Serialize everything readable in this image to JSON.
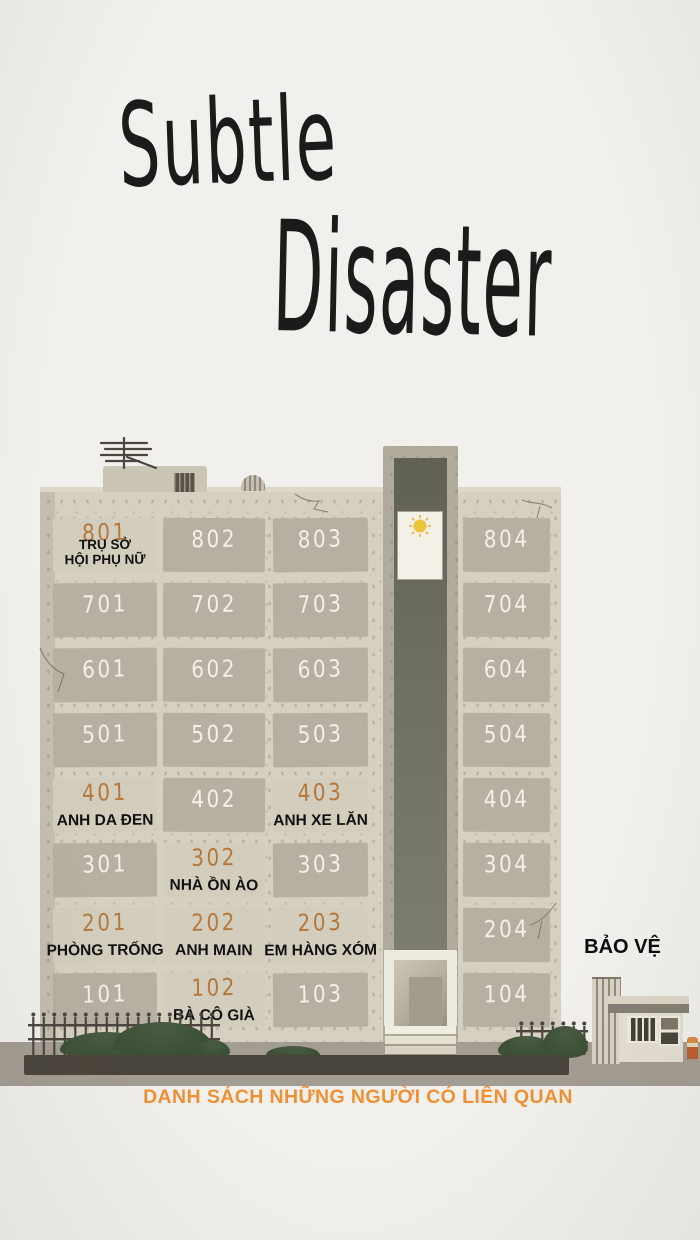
{
  "title": {
    "word1": "Subtle",
    "word2": "Disaster"
  },
  "building": {
    "floors": [
      {
        "level": 8,
        "rooms": [
          {
            "number": "801",
            "highlighted": true,
            "label_lines": [
              "TRỤ SỞ",
              "HỘI PHỤ NỮ"
            ]
          },
          {
            "number": "802",
            "highlighted": false
          },
          {
            "number": "803",
            "highlighted": false
          },
          {
            "number": "804",
            "highlighted": false
          }
        ]
      },
      {
        "level": 7,
        "rooms": [
          {
            "number": "701",
            "highlighted": false
          },
          {
            "number": "702",
            "highlighted": false
          },
          {
            "number": "703",
            "highlighted": false
          },
          {
            "number": "704",
            "highlighted": false
          }
        ]
      },
      {
        "level": 6,
        "rooms": [
          {
            "number": "601",
            "highlighted": false
          },
          {
            "number": "602",
            "highlighted": false
          },
          {
            "number": "603",
            "highlighted": false
          },
          {
            "number": "604",
            "highlighted": false
          }
        ]
      },
      {
        "level": 5,
        "rooms": [
          {
            "number": "501",
            "highlighted": false
          },
          {
            "number": "502",
            "highlighted": false
          },
          {
            "number": "503",
            "highlighted": false
          },
          {
            "number": "504",
            "highlighted": false
          }
        ]
      },
      {
        "level": 4,
        "rooms": [
          {
            "number": "401",
            "highlighted": true,
            "label_lines": [
              "ANH DA ĐEN"
            ]
          },
          {
            "number": "402",
            "highlighted": false
          },
          {
            "number": "403",
            "highlighted": true,
            "label_lines": [
              "ANH XE LĂN"
            ]
          },
          {
            "number": "404",
            "highlighted": false
          }
        ]
      },
      {
        "level": 3,
        "rooms": [
          {
            "number": "301",
            "highlighted": false
          },
          {
            "number": "302",
            "highlighted": true,
            "label_lines": [
              "NHÀ ỒN ÀO"
            ]
          },
          {
            "number": "303",
            "highlighted": false
          },
          {
            "number": "304",
            "highlighted": false
          }
        ]
      },
      {
        "level": 2,
        "rooms": [
          {
            "number": "201",
            "highlighted": true,
            "label_lines": [
              "PHÒNG TRỐNG"
            ]
          },
          {
            "number": "202",
            "highlighted": true,
            "label_lines": [
              "ANH MAIN"
            ]
          },
          {
            "number": "203",
            "highlighted": true,
            "label_lines": [
              "EM HÀNG XÓM"
            ]
          },
          {
            "number": "204",
            "highlighted": false
          }
        ]
      },
      {
        "level": 1,
        "rooms": [
          {
            "number": "101",
            "highlighted": false
          },
          {
            "number": "102",
            "highlighted": true,
            "label_lines": [
              "BÀ CÔ GIÀ"
            ]
          },
          {
            "number": "103",
            "highlighted": false
          },
          {
            "number": "104",
            "highlighted": false
          }
        ]
      }
    ]
  },
  "guard_house": {
    "label": "BẢO VỆ"
  },
  "caption": "DANH SÁCH NHỮNG NGƯỜI CÓ LIÊN QUAN",
  "colors": {
    "background": "#f1f0ec",
    "facade": "#d6d0c2",
    "window": "#b7b0a2",
    "window_lit": "#d3cdbe",
    "number_white": "#f3f0e6",
    "number_orange": "#b5783c",
    "label_black": "#111111",
    "caption_orange": "#ee9135",
    "tower_frame": "#b1ab9d",
    "tower_shaft": "#6f6f62",
    "entrance_white": "#edeadf",
    "sun_yellow": "#edc33a",
    "bush_green": "#3d5037",
    "curb_dark": "#49443b",
    "ground_gray": "#a39c92",
    "guard_wall": "#e4dfd2"
  }
}
